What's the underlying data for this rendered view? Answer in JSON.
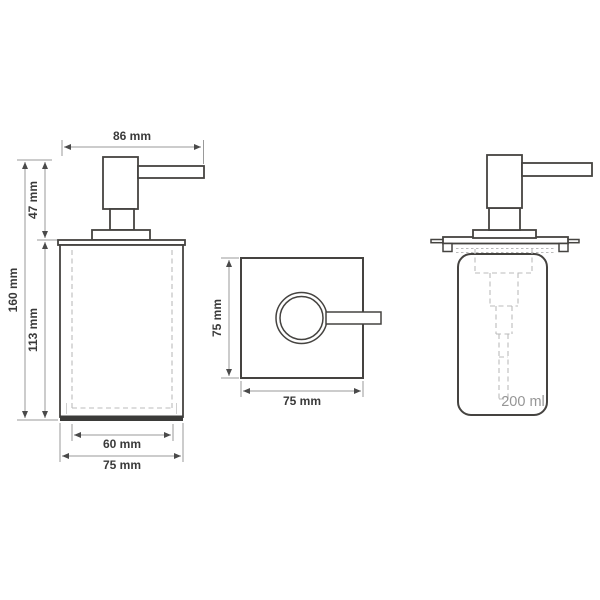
{
  "colors": {
    "bg": "#ffffff",
    "outline": "#454340",
    "dim-line": "#9a9a9a",
    "arrow": "#4a4a4a",
    "label": "#3a3a3a",
    "dash": "#bbbbbb",
    "volume": "#969696",
    "base-fill": "#3b3b39"
  },
  "front_view": {
    "dim_pump_width": "86 mm",
    "dim_pump_height": "47 mm",
    "dim_total_height": "160 mm",
    "dim_body_height": "113 mm",
    "dim_inner_width": "60 mm",
    "dim_outer_width": "75 mm"
  },
  "top_view": {
    "dim_depth": "75 mm",
    "dim_width": "75 mm"
  },
  "side_view": {
    "volume": "200 ml"
  }
}
